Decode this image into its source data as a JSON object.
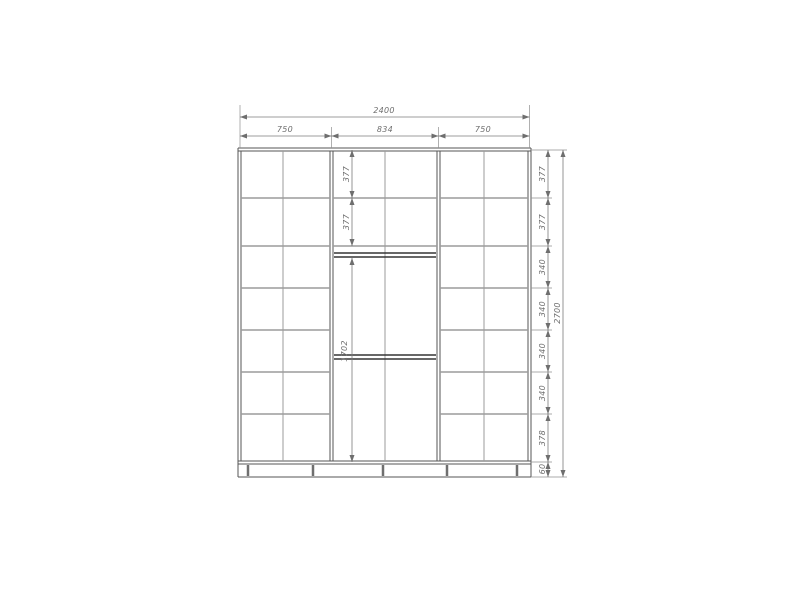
{
  "drawing": {
    "type": "wardrobe-elevation-technical-drawing",
    "colors": {
      "structure_dark": "#565656",
      "structure_light": "#9b9b9b",
      "dimension_gray": "#6e6e6e",
      "background": "#ffffff"
    },
    "dims": {
      "overall_width": "2400",
      "section_widths": [
        "750",
        "834",
        "750"
      ],
      "right_rows": [
        "377",
        "377",
        "340",
        "340",
        "340",
        "340",
        "378",
        "60"
      ],
      "overall_height": "2700",
      "middle_rows": [
        "377",
        "377"
      ],
      "middle_hanging": "1702"
    }
  }
}
